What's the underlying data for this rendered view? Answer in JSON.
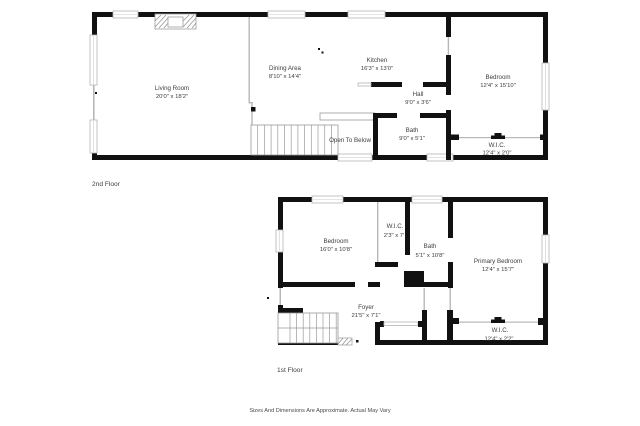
{
  "floor2": {
    "label": "2nd Floor",
    "living": {
      "name": "Living Room",
      "dims": "20'0\" x 18'2\""
    },
    "dining": {
      "name": "Dining Area",
      "dims": "8'10\" x 14'4\""
    },
    "kitchen": {
      "name": "Kitchen",
      "dims": "16'3\" x 13'0\""
    },
    "hall": {
      "name": "Hall",
      "dims": "9'0\" x 3'6\""
    },
    "bath": {
      "name": "Bath",
      "dims": "9'0\" x 5'1\""
    },
    "bedroom": {
      "name": "Bedroom",
      "dims": "12'4\" x 15'10\""
    },
    "wic": {
      "name": "W.I.C.",
      "dims": "12'4\" x 2'0\""
    },
    "open_to_below": "Open To Below"
  },
  "floor1": {
    "label": "1st Floor",
    "bedroom": {
      "name": "Bedroom",
      "dims": "16'0\" x 10'8\""
    },
    "wic_small": {
      "name": "W.I.C.",
      "dims": "2'3\" x 7'"
    },
    "bath": {
      "name": "Bath",
      "dims": "5'1\" x 10'8\""
    },
    "primary": {
      "name": "Primary Bedroom",
      "dims": "12'4\" x 15'7\""
    },
    "foyer": {
      "name": "Foyer",
      "dims": "21'5\" x 7'1\""
    },
    "wic": {
      "name": "W.I.C.",
      "dims": "12'4\" x 2'2\""
    }
  },
  "footer": "Sizes And Dimensions Are Approximate. Actual May Vary",
  "colors": {
    "wall": "#111111",
    "text": "#3d3d3d",
    "window_frame": "#b5b5b5"
  }
}
